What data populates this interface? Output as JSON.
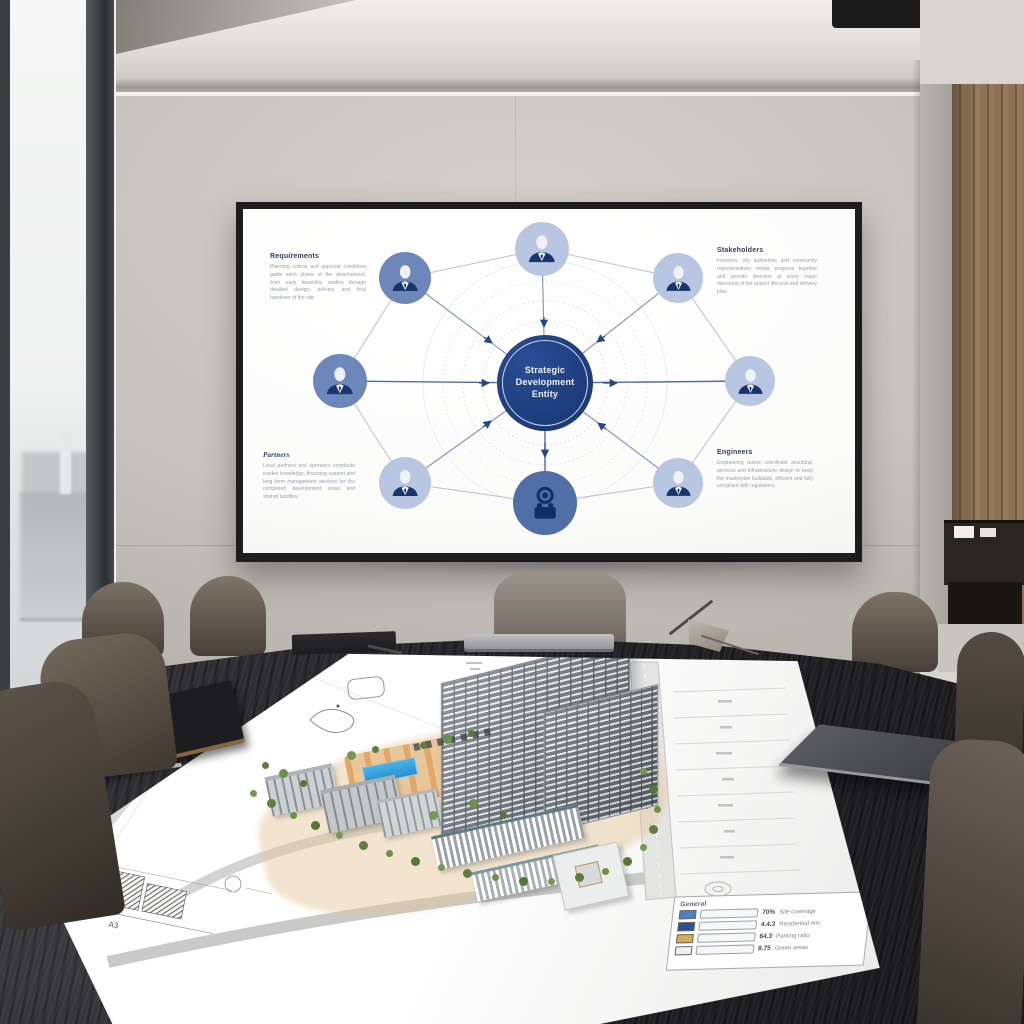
{
  "screen_diagram": {
    "center_label": "Strategic\nDevelopment\nEntity",
    "callouts": [
      {
        "heading": "Requirements",
        "body": "Planning criteria and approval conditions guide each phase of the development, from early feasibility studies through detailed design, delivery and final handover of the site."
      },
      {
        "heading": "Stakeholders",
        "body": "Investors, city authorities and community representatives review progress together and provide direction at every major milestone of the project lifecycle and delivery plan."
      },
      {
        "heading": "Partners",
        "body": "Local partners and operators contribute market knowledge, financing support and long term management services for the completed development areas and shared facilities."
      },
      {
        "heading": "Engineers",
        "body": "Engineering teams coordinate structural, services and infrastructure design to keep the masterplan buildable, efficient and fully compliant with regulations."
      }
    ],
    "nodes": [
      {
        "position": "top",
        "icon": "person",
        "tone": "light"
      },
      {
        "position": "top-left",
        "icon": "person",
        "tone": "medium"
      },
      {
        "position": "left",
        "icon": "person",
        "tone": "medium"
      },
      {
        "position": "bottom-left",
        "icon": "person",
        "tone": "light"
      },
      {
        "position": "bottom",
        "icon": "equipment",
        "tone": "deep"
      },
      {
        "position": "top-right",
        "icon": "person",
        "tone": "light"
      },
      {
        "position": "right",
        "icon": "person",
        "tone": "light"
      },
      {
        "position": "bottom-right",
        "icon": "person",
        "tone": "light"
      }
    ],
    "colors": {
      "center": "#1e3d7c",
      "node_light": "#b9c6e1",
      "node_medium": "#6e87bb",
      "node_deep": "#4f6fa6",
      "spoke": "#7d92b8",
      "ring": "#b9c1cf",
      "arrow": "#24478c"
    }
  },
  "site_plan": {
    "sheet_label": "A3",
    "legend": {
      "title": "General",
      "rows": [
        {
          "swatch": "#4d82c4",
          "swatch_css": "background:#4d82c4",
          "value": "70%",
          "label": "Site coverage"
        },
        {
          "swatch": "#27549b",
          "swatch_css": "background:#27549b",
          "value": "4.4.3",
          "label": "Residential mix"
        },
        {
          "swatch": "#ddaa55",
          "swatch_css": "background:#ddaa55",
          "value": "64.3",
          "label": "Parking ratio"
        },
        {
          "swatch": "#f0efec",
          "swatch_css": "background:#f0efec",
          "value": "8.75",
          "label": "Green areas"
        }
      ]
    }
  }
}
